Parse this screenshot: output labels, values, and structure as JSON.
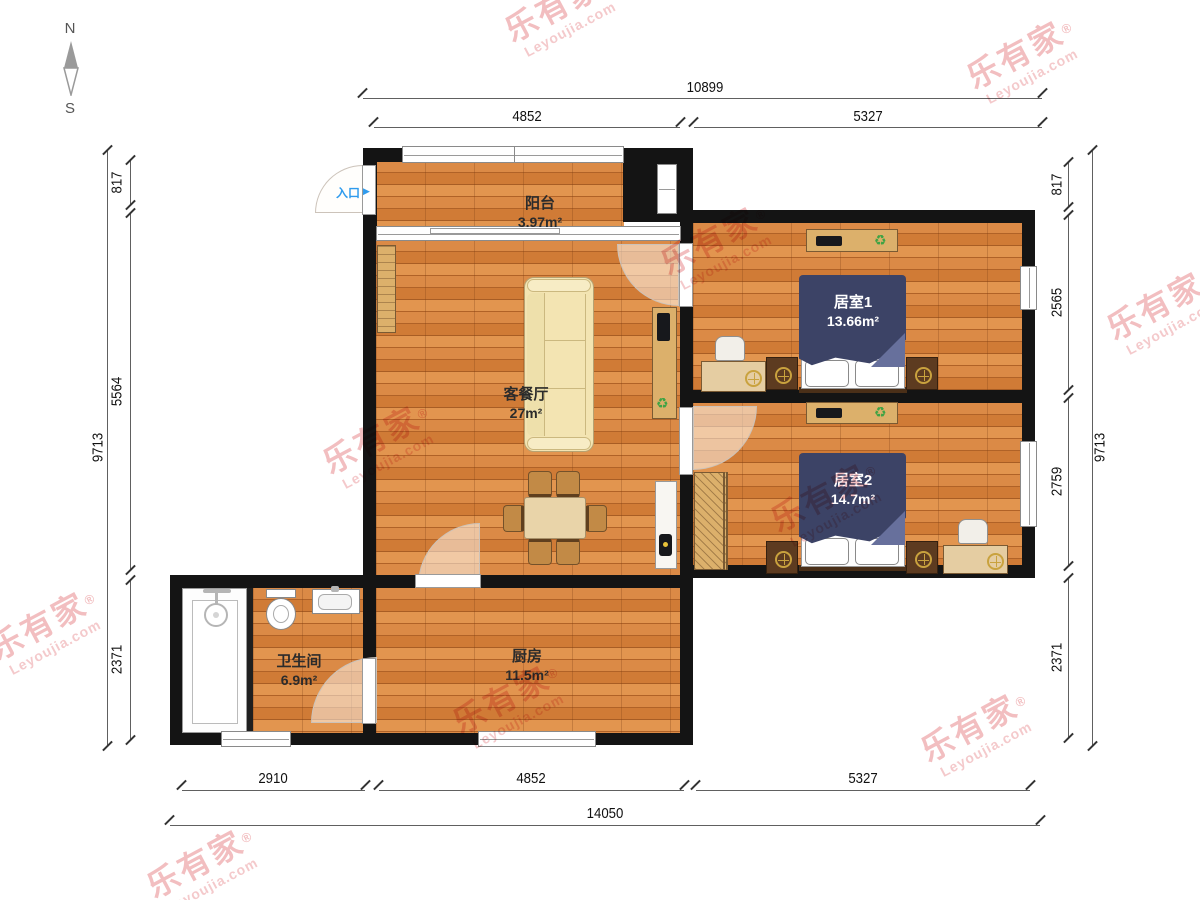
{
  "compass": {
    "north": "N",
    "south": "S"
  },
  "entrance": {
    "label": "入口",
    "arrow": "▶"
  },
  "watermark": {
    "brand": "乐有家",
    "reg": "®",
    "domain": "Leyoujia.com"
  },
  "rooms": {
    "balcony": {
      "name": "阳台",
      "area": "3.97m²"
    },
    "living": {
      "name": "客餐厅",
      "area": "27m²"
    },
    "bedroom1": {
      "name": "居室1",
      "area": "13.66m²"
    },
    "bedroom2": {
      "name": "居室2",
      "area": "14.7m²"
    },
    "bathroom": {
      "name": "卫生间",
      "area": "6.9m²"
    },
    "kitchen": {
      "name": "厨房",
      "area": "11.5m²"
    }
  },
  "dimensions": {
    "top": {
      "total": "10899",
      "segments": [
        "4852",
        "5327"
      ]
    },
    "bottom": {
      "total": "14050",
      "segments": [
        "2910",
        "4852",
        "5327"
      ]
    },
    "left": {
      "total": "9713",
      "segments": [
        "817",
        "5564",
        "2371"
      ]
    },
    "right": {
      "total": "9713",
      "segments": [
        "817",
        "2565",
        "2759",
        "2371"
      ]
    }
  },
  "icons": {
    "recycle": "♻"
  }
}
